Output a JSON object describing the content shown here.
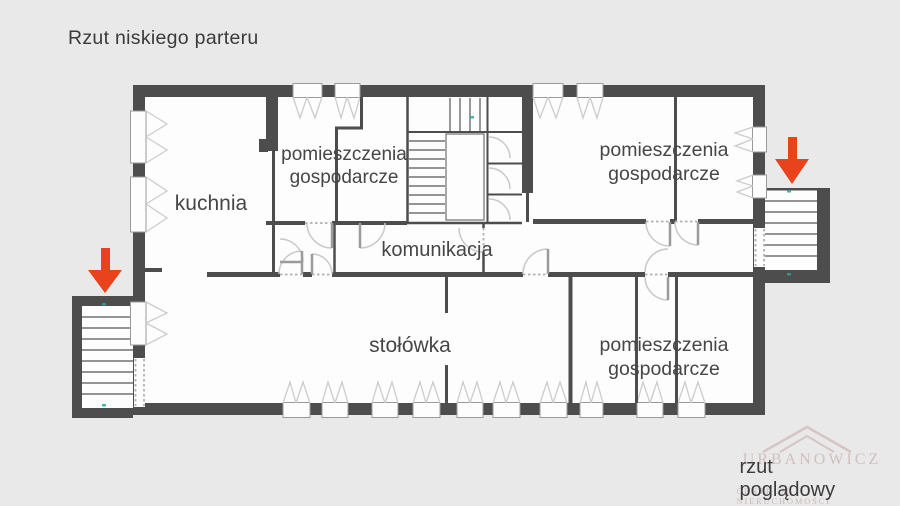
{
  "title": "Rzut niskiego parteru",
  "caption": "rzut poglądowy",
  "watermark": {
    "name": "URBANOWICZ",
    "subtitle": "CENTRUM NIERUCHOMOŚCI"
  },
  "rooms": {
    "kuchnia": {
      "label": "kuchnia"
    },
    "utility_top": {
      "line1": "pomieszczenia",
      "line2": "gospodarcze"
    },
    "utility_right": {
      "line1": "pomieszczenia",
      "line2": "gospodarcze"
    },
    "komunikacja": {
      "label": "komunikacja"
    },
    "stolowka": {
      "label": "stołówka"
    },
    "utility_bottom": {
      "line1": "pomieszczenia",
      "line2": "gospodarcze"
    }
  },
  "colors": {
    "background": "#e9e9e9",
    "floor": "#fdfdfd",
    "walls": "#4d4d4d",
    "arrow": "#e8431c",
    "watermark": "#c8a9a9"
  }
}
